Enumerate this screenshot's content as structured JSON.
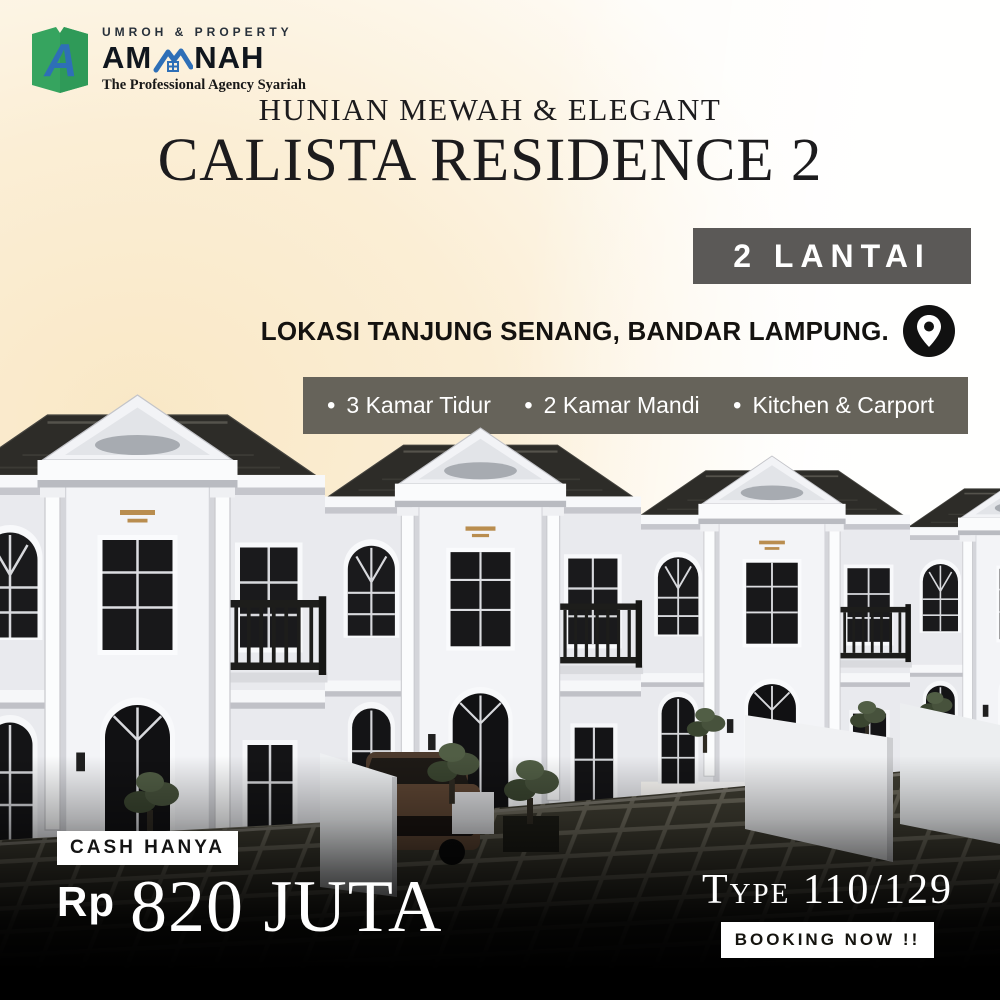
{
  "brand": {
    "tagline_top": "UMROH & PROPERTY",
    "monogram": "A",
    "name_prefix": "AM",
    "name_suffix": "NAH",
    "tagline_bottom": "The Professional Agency Syariah"
  },
  "header": {
    "subtitle": "HUNIAN MEWAH & ELEGANT",
    "title": "CALISTA RESIDENCE 2"
  },
  "floors_badge": "2 LANTAI",
  "location_text": "LOKASI TANJUNG SENANG, BANDAR LAMPUNG.",
  "features": {
    "bullet": "•",
    "items": [
      "3 Kamar Tidur",
      "2 Kamar Mandi",
      "Kitchen & Carport"
    ]
  },
  "offer": {
    "cash_label": "CASH HANYA",
    "currency": "Rp",
    "amount": "820 JUTA"
  },
  "spec": {
    "type_label": "Type 110/129",
    "booking_label": "BOOKING NOW !!"
  },
  "colors": {
    "brand_green": "#36a45f",
    "brand_blue": "#2e6fb7",
    "badge_gray": "#5b5957",
    "features_bar": "#66635a",
    "glow_cream": "#f9e8c6",
    "gold": "#b98d4f"
  }
}
